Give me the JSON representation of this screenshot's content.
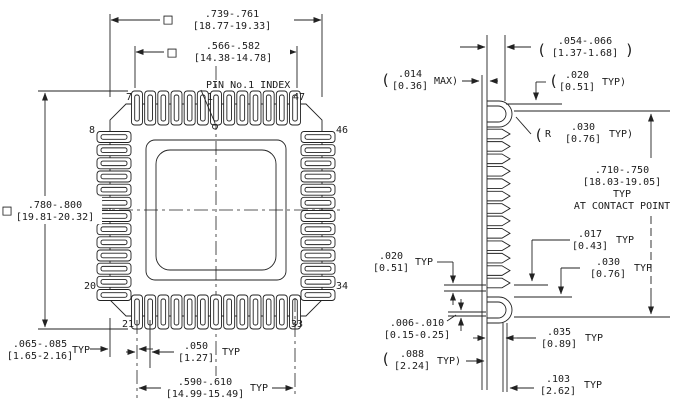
{
  "top_view": {
    "pins_per_side": 13,
    "pin1_note": "PIN No.1 INDEX",
    "pin_labels": {
      "p7": "7",
      "p1": "1",
      "p47": "47",
      "p8": "8",
      "p46": "46",
      "p20": "20",
      "p34": "34",
      "p21": "21",
      "p33": "33"
    },
    "dims": {
      "outer_body": {
        "symbol": "□",
        "inch": ".739-.761",
        "mm": "[18.77-19.33]"
      },
      "inner_body": {
        "symbol": "□",
        "inch": ".566-.582",
        "mm": "[14.38-14.78]"
      },
      "overall": {
        "symbol": "□",
        "inch": ".780-.800",
        "mm": "[19.81-20.32]"
      },
      "corner_offset": {
        "inch": ".065-.085",
        "mm": "[1.65-2.16]",
        "suffix": "TYP"
      },
      "pitch": {
        "inch": ".050",
        "mm": "[1.27]",
        "suffix": "TYP"
      },
      "lead_row_span": {
        "inch": ".590-.610",
        "mm": "[14.99-15.49]",
        "suffix": "TYP"
      }
    }
  },
  "side_view": {
    "lead_bumps": 13,
    "dims": {
      "lead_width": {
        "open": "(",
        "inch": ".054-.066",
        "mm": "[1.37-1.68]",
        "close": ")"
      },
      "protrusion": {
        "open": "(",
        "inch": ".014",
        "mm": "[0.36]",
        "close": "MAX)"
      },
      "lead_thickness_top": {
        "open": "(",
        "inch": ".020",
        "mm": "[0.51]",
        "close": "TYP)"
      },
      "lead_radius": {
        "open": "(",
        "r": "R",
        "inch": ".030",
        "mm": "[0.76]",
        "close": "TYP)"
      },
      "contact_span": {
        "inch": ".710-.750",
        "mm": "[18.03-19.05]",
        "typ": "TYP",
        "note": "AT CONTACT POINT"
      },
      "lead_thickness_bottom": {
        "inch": ".017",
        "mm": "[0.43]",
        "suffix": "TYP"
      },
      "hook_clearance": {
        "inch": ".030",
        "mm": "[0.76]",
        "suffix": "TYP"
      },
      "lead_gap": {
        "inch": ".020",
        "mm": "[0.51]",
        "suffix": "TYP"
      },
      "standoff": {
        "inch": ".006-.010",
        "mm": "[0.15-0.25]"
      },
      "foot_width": {
        "inch": ".035",
        "mm": "[0.89]",
        "suffix": "TYP"
      },
      "curl_depth": {
        "open": "(",
        "inch": ".088",
        "mm": "[2.24]",
        "close": "TYP)"
      },
      "overall_depth": {
        "inch": ".103",
        "mm": "[2.62]",
        "suffix": "TYP"
      }
    }
  }
}
